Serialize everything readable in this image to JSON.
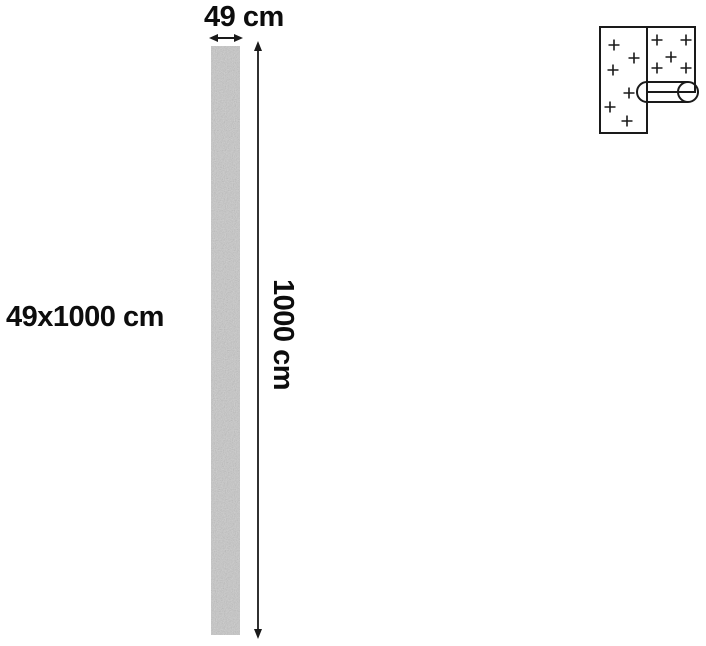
{
  "dimensions": {
    "width_label": "49 cm",
    "height_label": "1000 cm",
    "size_label": "49x1000 cm"
  },
  "style": {
    "background": "#ffffff",
    "line_color": "#1a1a1a",
    "text_color": "#0d0d0d",
    "strip_fill": "#c8c8c8"
  },
  "icon": {
    "name": "wallpaper-roll-icon"
  }
}
